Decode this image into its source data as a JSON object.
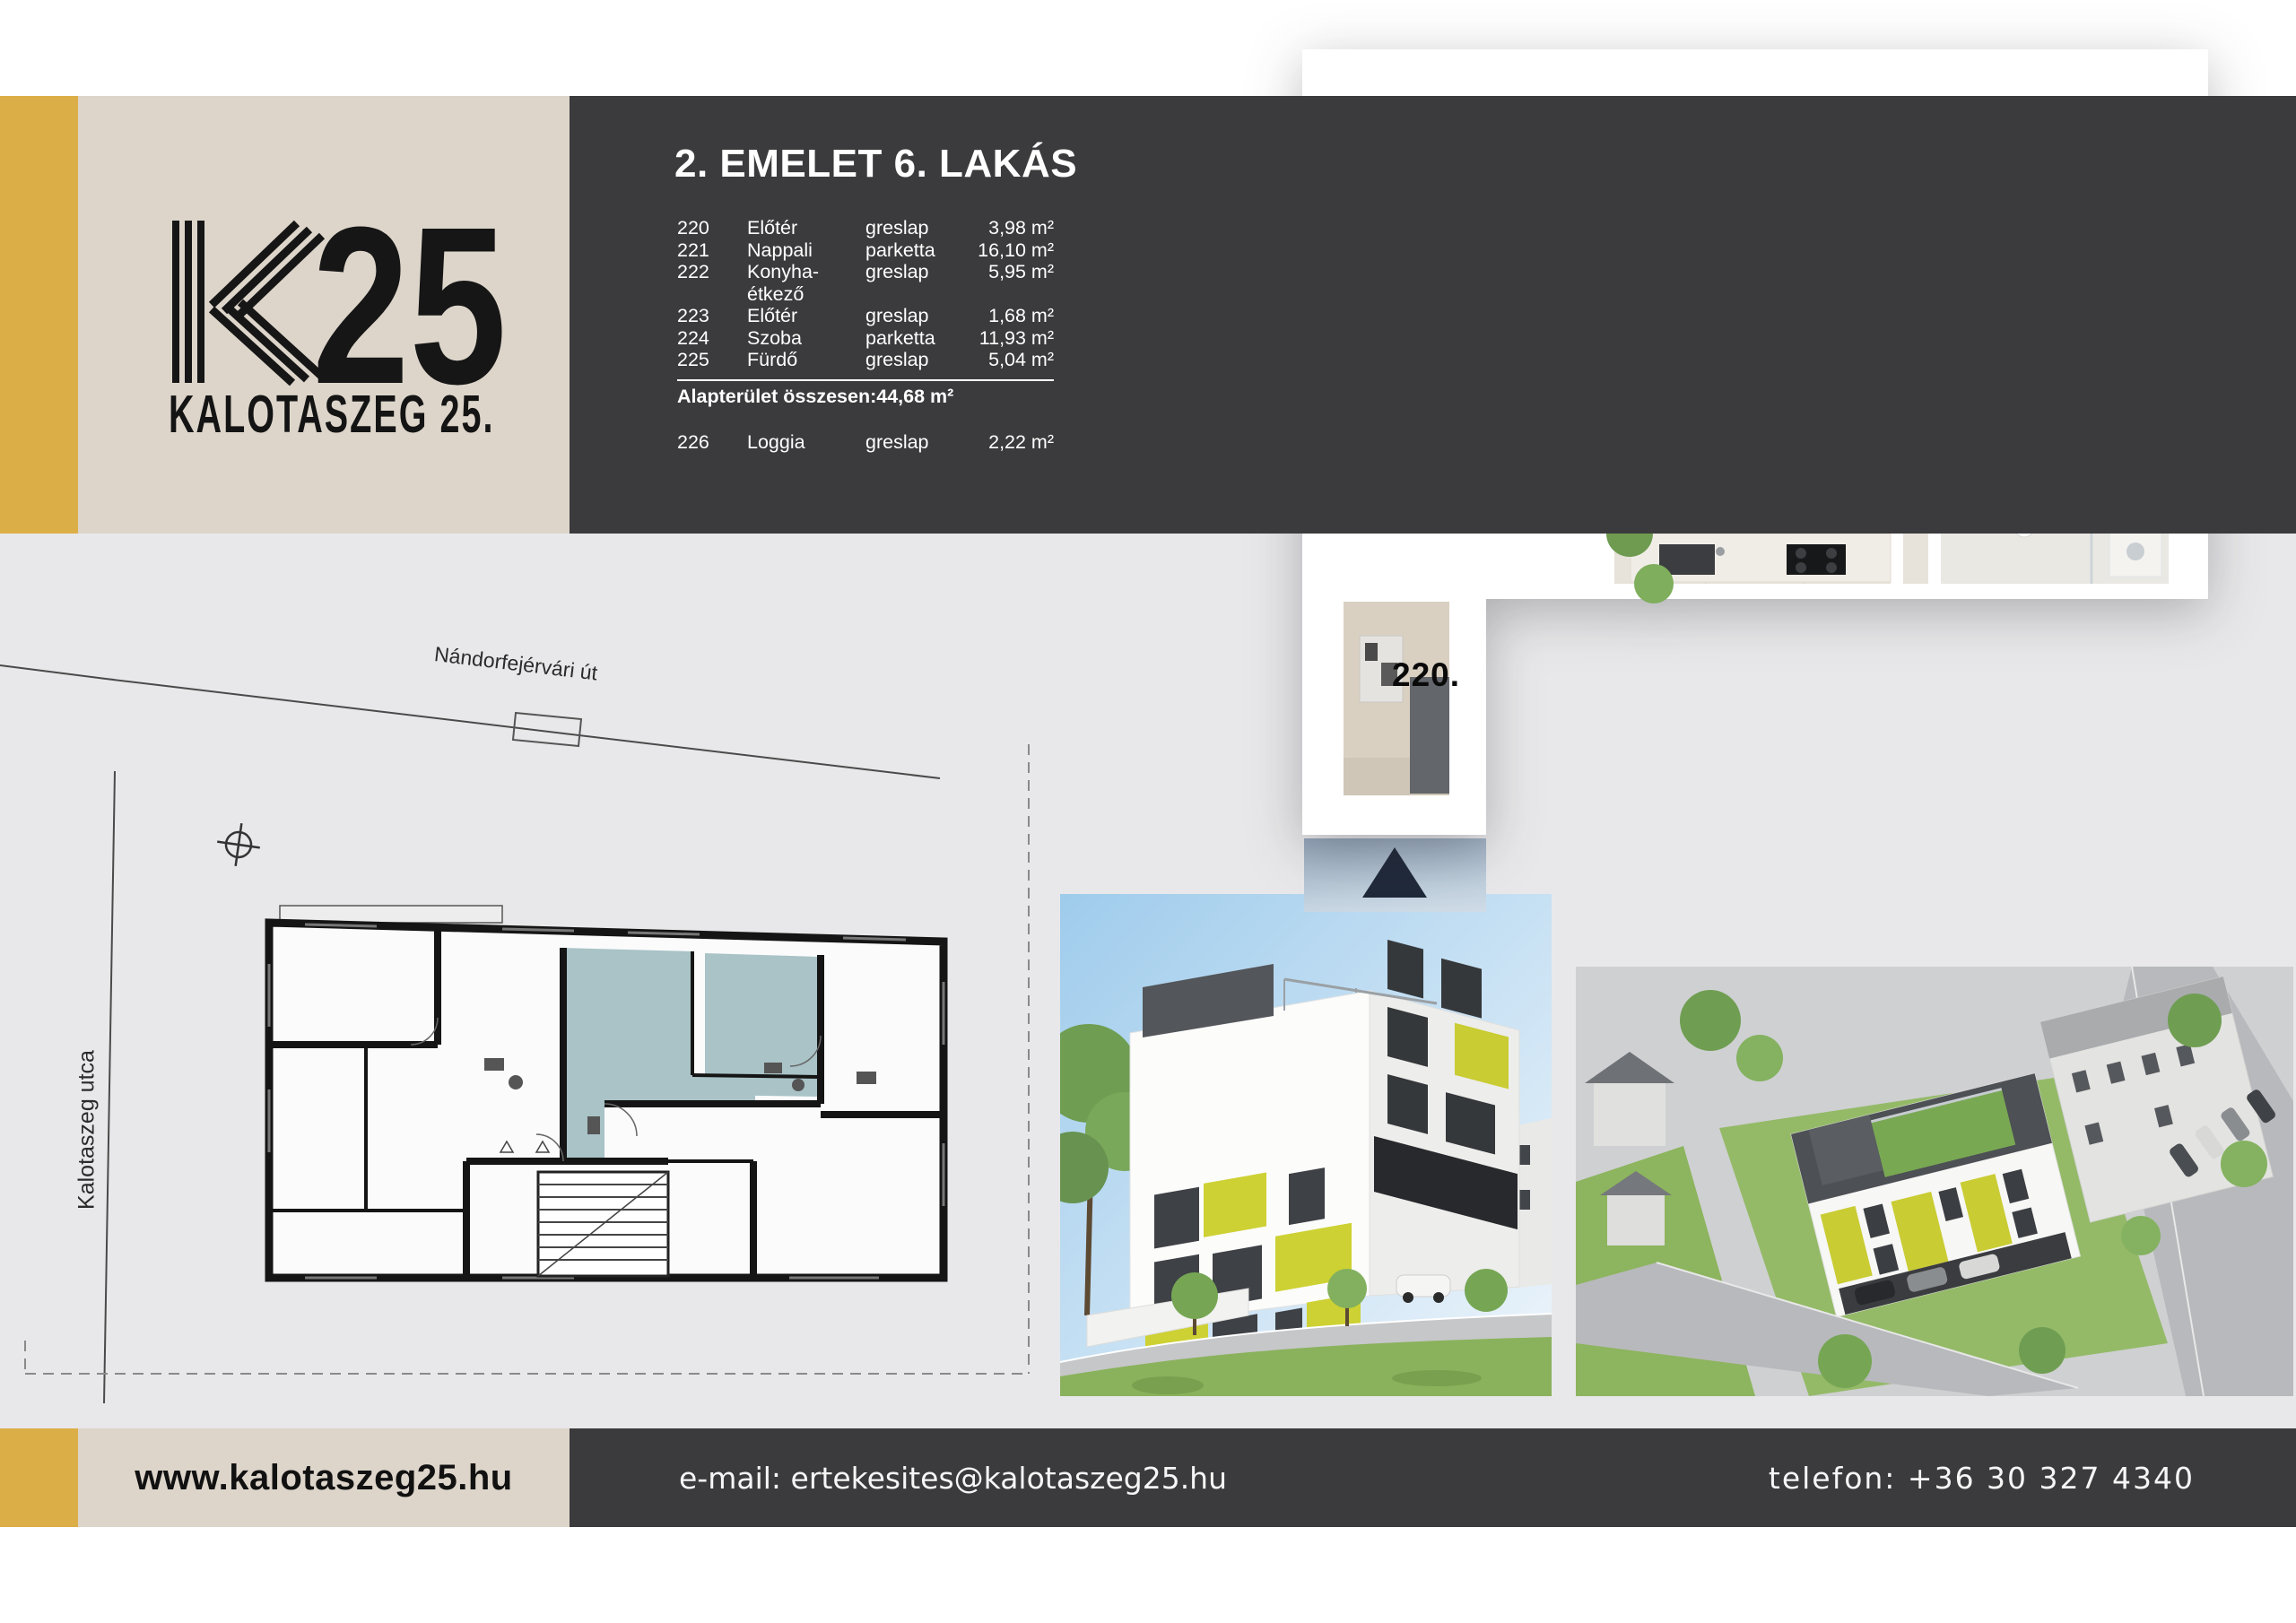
{
  "logo": {
    "number": "25",
    "subtitle": "KALOTASZEG 25."
  },
  "unit": {
    "title": "2. EMELET 6. LAKÁS",
    "rooms": [
      {
        "num": "220",
        "name": "Előtér",
        "floor": "greslap",
        "area": "3,98 m²"
      },
      {
        "num": "221",
        "name": "Nappali",
        "floor": "parketta",
        "area": "16,10 m²"
      },
      {
        "num": "222",
        "name": "Konyha-étkező",
        "floor": "greslap",
        "area": "5,95 m²"
      },
      {
        "num": "223",
        "name": "Előtér",
        "floor": "greslap",
        "area": "1,68 m²"
      },
      {
        "num": "224",
        "name": "Szoba",
        "floor": "parketta",
        "area": "11,93 m²"
      },
      {
        "num": "225",
        "name": "Fürdő",
        "floor": "greslap",
        "area": "5,04 m²"
      }
    ],
    "total_label": "Alapterület összesen:",
    "total_area": "44,68 m²",
    "extra": {
      "num": "226",
      "name": "Loggia",
      "floor": "greslap",
      "area": "2,22 m²"
    }
  },
  "plan3d": {
    "labels": {
      "hall": "220.",
      "living": "221.",
      "kitchen": "222.",
      "bedroom": "224.",
      "bath": "225.",
      "loggia": "226."
    }
  },
  "siteplan": {
    "street_top": "Nándorfejérvári út",
    "street_left": "Kalotaszeg utca"
  },
  "footer": {
    "website": "www.kalotaszeg25.hu",
    "email": "e-mail: ertekesites@kalotaszeg25.hu",
    "phone": "telefon: +36 30 327 4340"
  },
  "colors": {
    "accent_gold": "#dcae47",
    "beige": "#ddd5ca",
    "dark_band": "#3b3b3d",
    "page_bg": "#e8e8ea",
    "highlight_teal": "#a9c3c7",
    "accent_lime": "#c9cc33"
  }
}
